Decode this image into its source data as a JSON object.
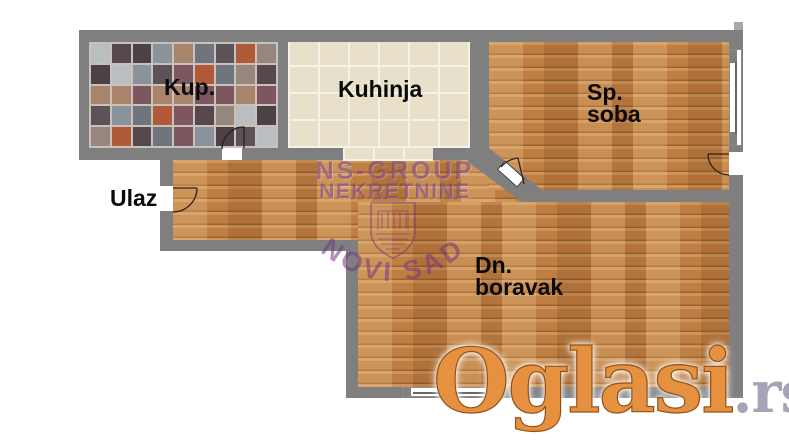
{
  "page": {
    "width": 789,
    "height": 447,
    "background": "#ffffff"
  },
  "rooms": {
    "bathroom": {
      "label": "Kup."
    },
    "kitchen": {
      "label": "Kuhinja"
    },
    "bedroom": {
      "lines": [
        "Sp.",
        "soba"
      ]
    },
    "entrance": {
      "label": "Ulaz"
    },
    "living_room": {
      "lines": [
        "Dn.",
        "boravak"
      ]
    }
  },
  "watermarks": {
    "agency": {
      "line1": "NS-GROUP",
      "line2": "NEKRETNINE",
      "seal_text": "NOVI SAD",
      "color": "rgba(115,55,130,0.55)"
    },
    "portal": {
      "text": "Oglasi",
      "suffix": ".rs",
      "orange": "#e5913f",
      "suffix_color": "#a8a3b6"
    }
  },
  "colors": {
    "wall": "#7f7f7f",
    "wood_base": "#bf7e42",
    "kitchen_tile": "#e9e0ca",
    "kitchen_grout": "#f5f2e8",
    "bathroom_grout": "#c9c1ba",
    "agency": "rgba(115,55,130,0.55)"
  },
  "bathroom_palette": [
    "#55474b",
    "#8a939b",
    "#b9bec1",
    "#b05a38",
    "#7d5660",
    "#5c5358",
    "#96867c",
    "#6e757d",
    "#4b4146",
    "#a8846a"
  ],
  "symbols": {
    "doors": [
      "bathroom-door",
      "entrance-door",
      "bedroom-door",
      "terrace-door"
    ],
    "windows": [
      "bedroom-window",
      "living-room-window"
    ]
  }
}
